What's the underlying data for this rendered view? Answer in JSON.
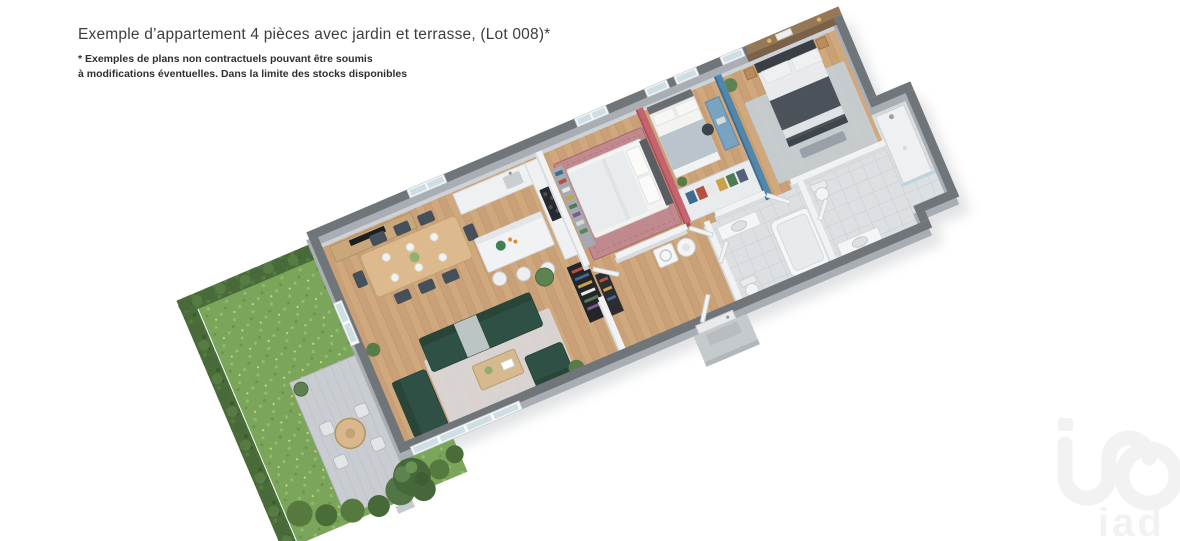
{
  "header": {
    "title": "Exemple d’appartement 4 pièces avec jardin et terrasse, (Lot 008)*",
    "disclaimer_line1": "* Exemples de plans non contractuels pouvant être soumis",
    "disclaimer_line2": "à modifications éventuelles. Dans la limite des stocks disponibles"
  },
  "watermark": {
    "label": "iad"
  },
  "floorplan": {
    "colors": {
      "outer_wall_top": "#70757a",
      "outer_wall_face": "#a8aeb3",
      "wood_floor": "#cfa87d",
      "tile_floor": "#dde0e3",
      "lawn_green": "#7aa55a",
      "hedge_green": "#4a6c39",
      "sofa_green": "#2f5045",
      "accent_pink": "#c5636f",
      "accent_pink_face": "#a94f5b",
      "accent_blue": "#5186ad",
      "accent_blue_face": "#3f6b8e",
      "accent_brown": "#977856",
      "accent_brown_face": "#7a6148",
      "terrace_paving": "#c9cdd1",
      "background": "#ffffff",
      "watermark_gray": "#f2f2f2"
    }
  }
}
